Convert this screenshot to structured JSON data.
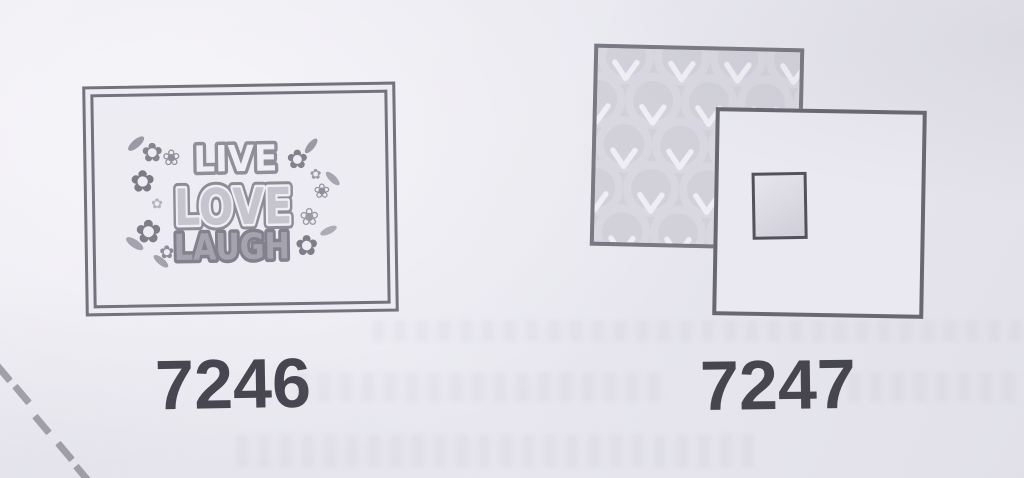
{
  "items": {
    "i7246": {
      "code": "7246",
      "art": {
        "word1": "LIVE",
        "word2": "LOVE",
        "word3": "LAUGH"
      }
    },
    "i7247": {
      "code": "7247"
    }
  },
  "icons": {
    "flower_solid": "✿",
    "flower_outline": "❀"
  },
  "colors": {
    "paper": "#e8e7ef",
    "frame_ink": "#73727d",
    "label_ink": "#47464f",
    "pattern_base": "#d2d1da",
    "pattern_motif": "#eeedf4",
    "square_border": "#686772",
    "dash": "#95949d"
  }
}
